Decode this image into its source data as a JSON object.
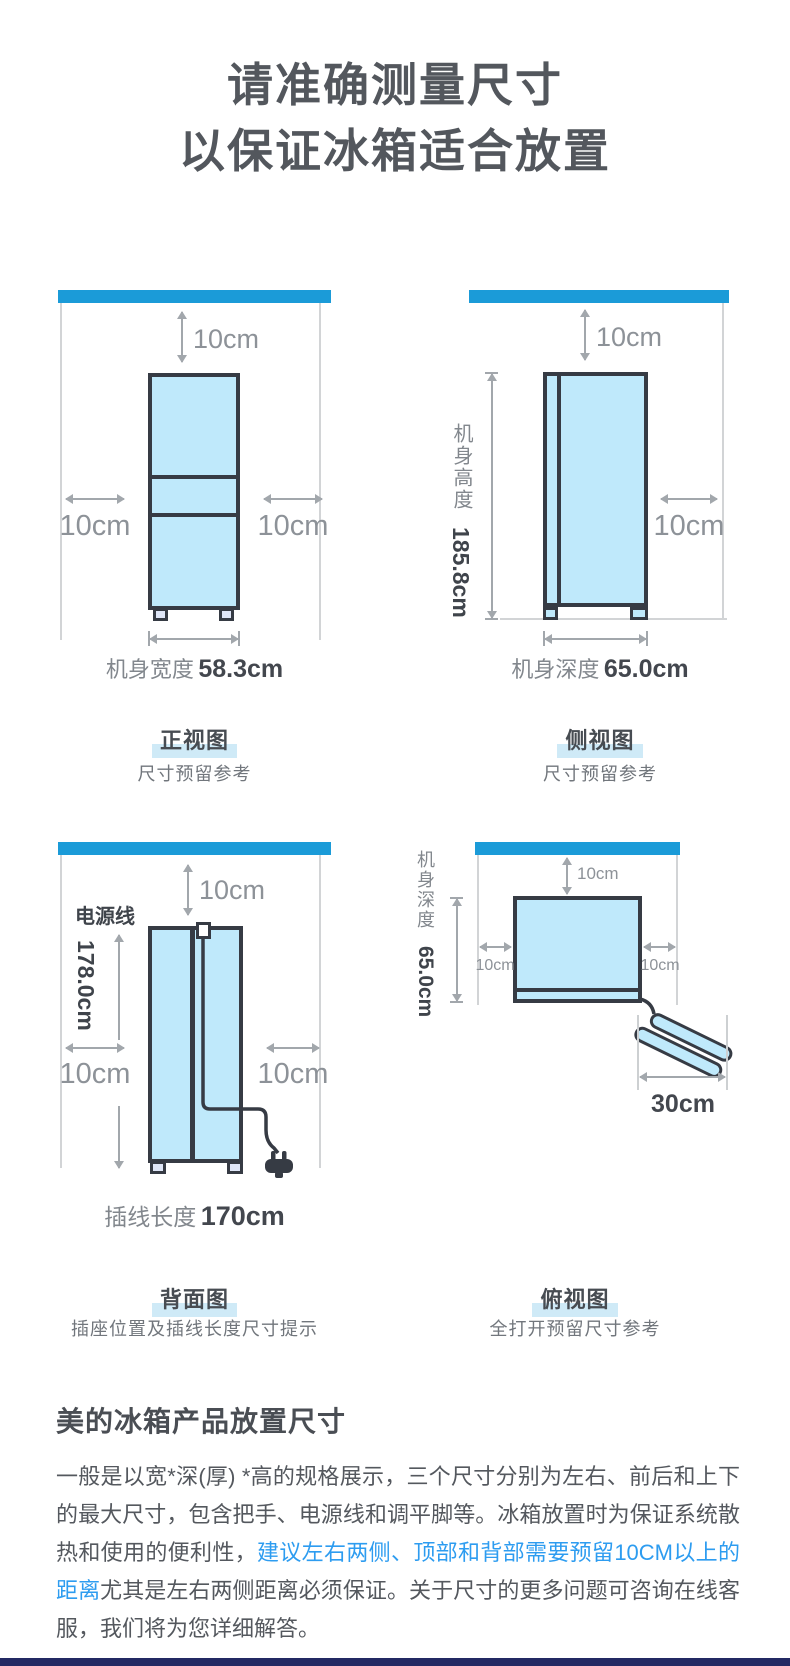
{
  "page_title": {
    "line1": "请准确测量尺寸",
    "line2": "以保证冰箱适合放置"
  },
  "diagrams": {
    "front": {
      "clearance_top": "10cm",
      "clearance_left": "10cm",
      "clearance_right": "10cm",
      "width_label": "机身宽度",
      "width_value": "58.3cm",
      "caption": "正视图",
      "subcaption": "尺寸预留参考"
    },
    "side": {
      "clearance_top": "10cm",
      "clearance_right": "10cm",
      "height_label": "机身高度",
      "height_value": "185.8cm",
      "depth_label": "机身深度",
      "depth_value": "65.0cm",
      "caption": "侧视图",
      "subcaption": "尺寸预留参考"
    },
    "back": {
      "power_cord_label": "电源线",
      "cord_drop_value": "178.0cm",
      "clearance_top": "10cm",
      "clearance_left": "10cm",
      "clearance_right": "10cm",
      "cord_length_label": "插线长度",
      "cord_length_value": "170cm",
      "caption": "背面图",
      "subcaption": "插座位置及插线长度尺寸提示"
    },
    "top": {
      "depth_label": "机身深度",
      "depth_value": "65.0cm",
      "clearance_top": "10cm",
      "clearance_left": "10cm",
      "clearance_right": "10cm",
      "door_open_value": "30cm",
      "caption": "俯视图",
      "subcaption": "全打开预留尺寸参考"
    }
  },
  "footer": {
    "heading": "美的冰箱产品放置尺寸",
    "para_before": "一般是以宽*深(厚) *高的规格展示，三个尺寸分别为左右、前后和上下的最大尺寸，包含把手、电源线和调平脚等。冰箱放置时为保证系统散热和使用的便利性，",
    "para_highlight": "建议左右两侧、顶部和背部需要预留10CM以上的距离",
    "para_after": "尤其是左右两侧距离必须保证。关于尺寸的更多问题可咨询在线客服，我们将为您详细解答。"
  },
  "colors": {
    "accent_blue": "#1b9bd8",
    "fridge_fill": "#bfe9fb",
    "outline_dark": "#363b44",
    "caption_highlight": "#cfeaf7",
    "link_blue": "#2d9cf0",
    "bottom_bar_navy": "#232963"
  }
}
